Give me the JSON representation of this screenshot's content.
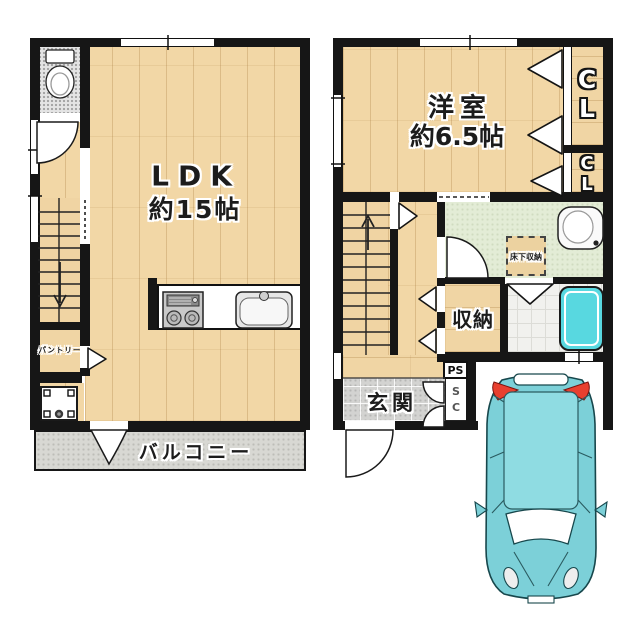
{
  "floorplan_title": "2-story house floor plan",
  "floor2": {
    "ldk_name": "LDK",
    "ldk_size": "約15帖",
    "pantry": "パントリー",
    "balcony": "バルコニー"
  },
  "floor1": {
    "room_name": "洋室",
    "room_size": "約6.5帖",
    "closet_upper": "CL",
    "closet_lower": "CL",
    "storage": "収納",
    "underfloor_storage": "床下収納",
    "entrance": "玄関",
    "pipe_space": "PS",
    "shoe_closet": "SC"
  },
  "colors": {
    "wall": "#161616",
    "wood_floor": "#f2d7a6",
    "tile_gray": "#d3d3d1",
    "washroom_green": "#e3ecd6",
    "bathtub_teal": "#58d8e0",
    "car_body_teal": "#7cd0d8",
    "car_roof_teal": "#8fdce2",
    "taillight_red": "#e8402f",
    "balcony_gray": "#d8d8d3"
  },
  "icons": {
    "toilet": "toilet-icon",
    "stove": "stove-icon",
    "sink": "kitchen-sink-icon",
    "washer_pan": "washer-pan-icon",
    "vanity": "vanity-sink-icon",
    "bathtub": "bathtub-icon",
    "car": "car-top-view-icon",
    "stairs_down": "stairs-down-arrow",
    "stairs_up": "stairs-up-arrow"
  }
}
